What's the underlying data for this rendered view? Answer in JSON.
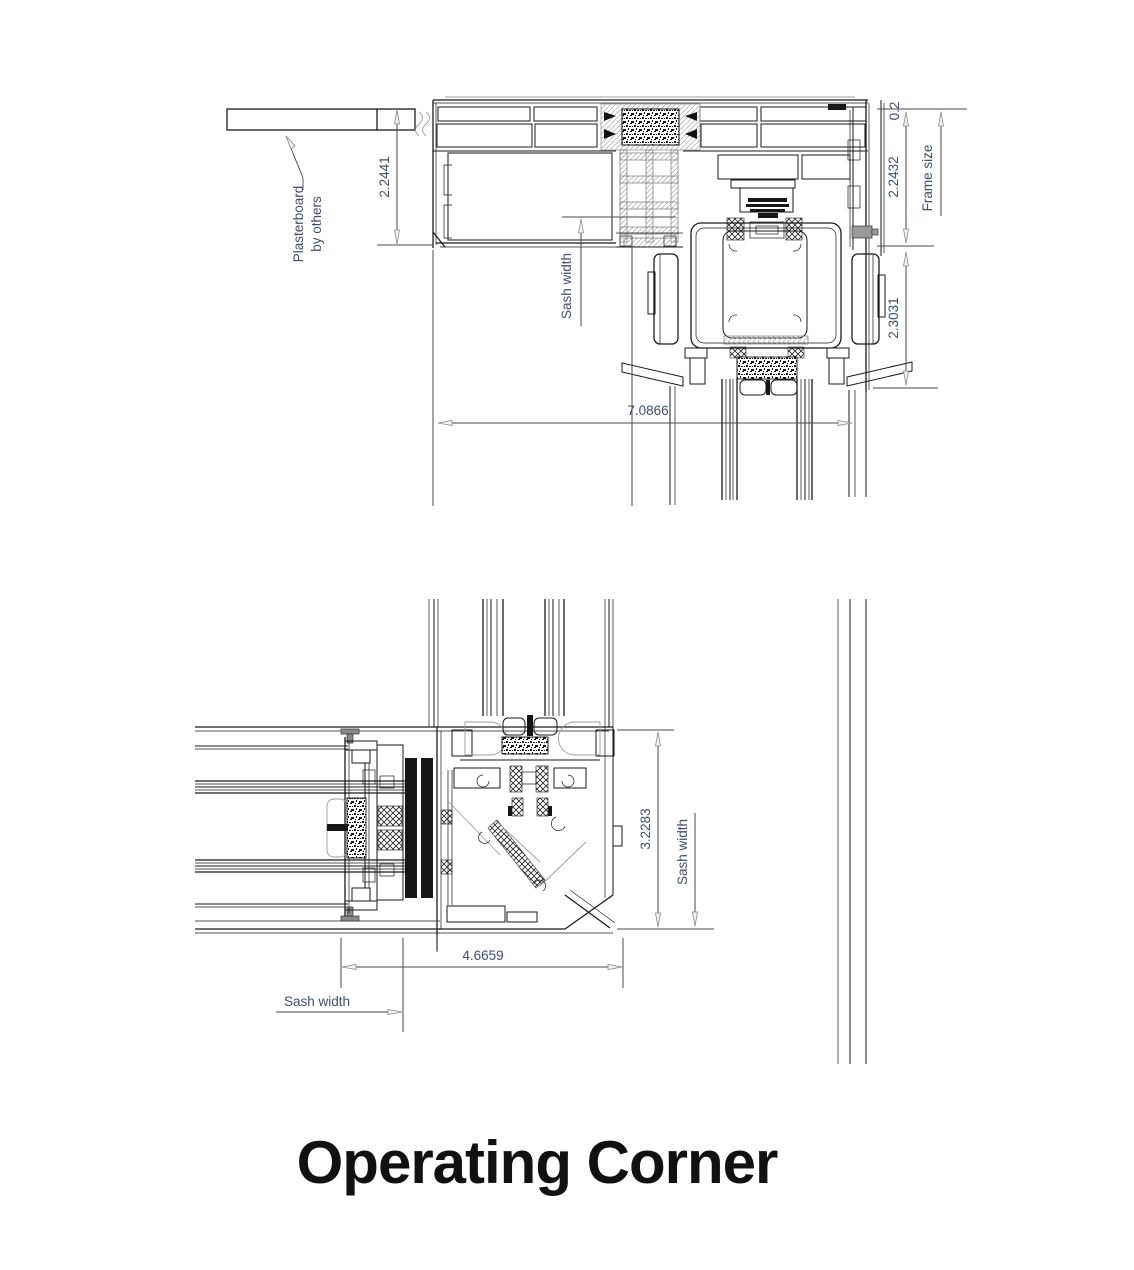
{
  "title": "Operating Corner",
  "colors": {
    "background": "#ffffff",
    "drawing_line": "#1a1a1a",
    "reference_line": "#9c9c9c",
    "dimension_line": "#4a4a4a",
    "dimension_text": "#3e4f70",
    "title_text": "#111111"
  },
  "top_view": {
    "labels": {
      "plasterboard_line1": "Plasterboard",
      "plasterboard_line2": "by others",
      "sash_width": "Sash width",
      "frame_size": "Frame size"
    },
    "dimensions": {
      "plasterboard_to_frame": "2.2441",
      "top_truncated": "0.2",
      "frame_upper": "2.2432",
      "frame_lower": "2.3031",
      "overall_width": "7.0866"
    }
  },
  "bottom_view": {
    "labels": {
      "sash_width_right": "Sash width",
      "sash_width_left": "Sash width"
    },
    "dimensions": {
      "corner_height": "3.2283",
      "corner_width": "4.6659"
    }
  }
}
